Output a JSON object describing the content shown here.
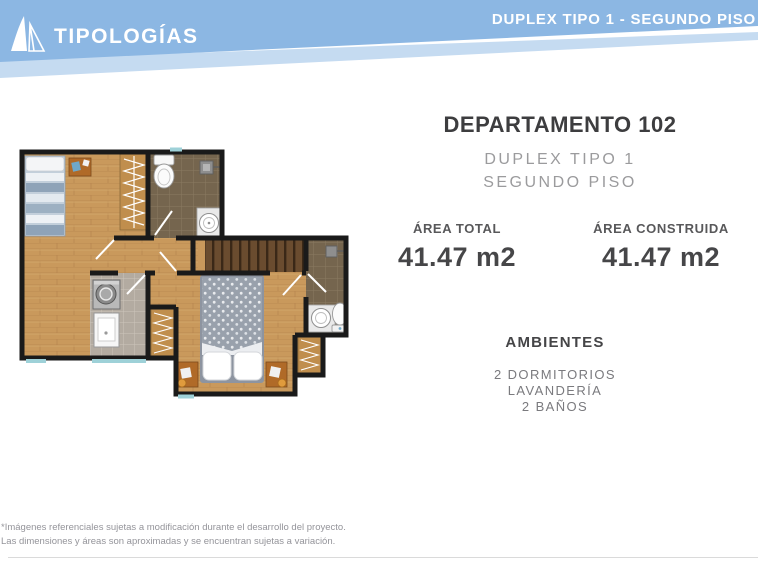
{
  "header": {
    "brand": "TIPOLOGÍAS",
    "logo_icon": "sail-triangles-logo-icon",
    "page_title": "DUPLEX TIPO 1 - SEGUNDO PISO",
    "colors": {
      "band_main": "#8cb7e3",
      "band_light": "#c5dbf1",
      "text": "#ffffff"
    }
  },
  "unit": {
    "title": "DEPARTAMENTO 102",
    "subtitle_line1": "DUPLEX TIPO 1",
    "subtitle_line2": "SEGUNDO PISO",
    "stats": [
      {
        "label": "ÁREA TOTAL",
        "value": "41.47 m2"
      },
      {
        "label": "ÁREA CONSTRUIDA",
        "value": "41.47 m2"
      }
    ],
    "ambientes": {
      "heading": "AMBIENTES",
      "items": [
        "2 DORMITORIOS",
        "LAVANDERÍA",
        "2 BAÑOS"
      ]
    }
  },
  "floor_plan": {
    "description_icon": "apartment-floor-plan-top-view",
    "colors": {
      "walls": "#1a1a1a",
      "wood_floor": "#c9995c",
      "bathroom_tile": "#75654e",
      "laundry_tile": "#b3aba1",
      "stairs": "#6a4c2f",
      "window": "#9ed1d8"
    }
  },
  "footer": {
    "line1": "*Imágenes referenciales sujetas a modificación durante el desarrollo del proyecto.",
    "line2": "Las dimensiones y áreas son aproximadas y se encuentran sujetas a variación."
  }
}
